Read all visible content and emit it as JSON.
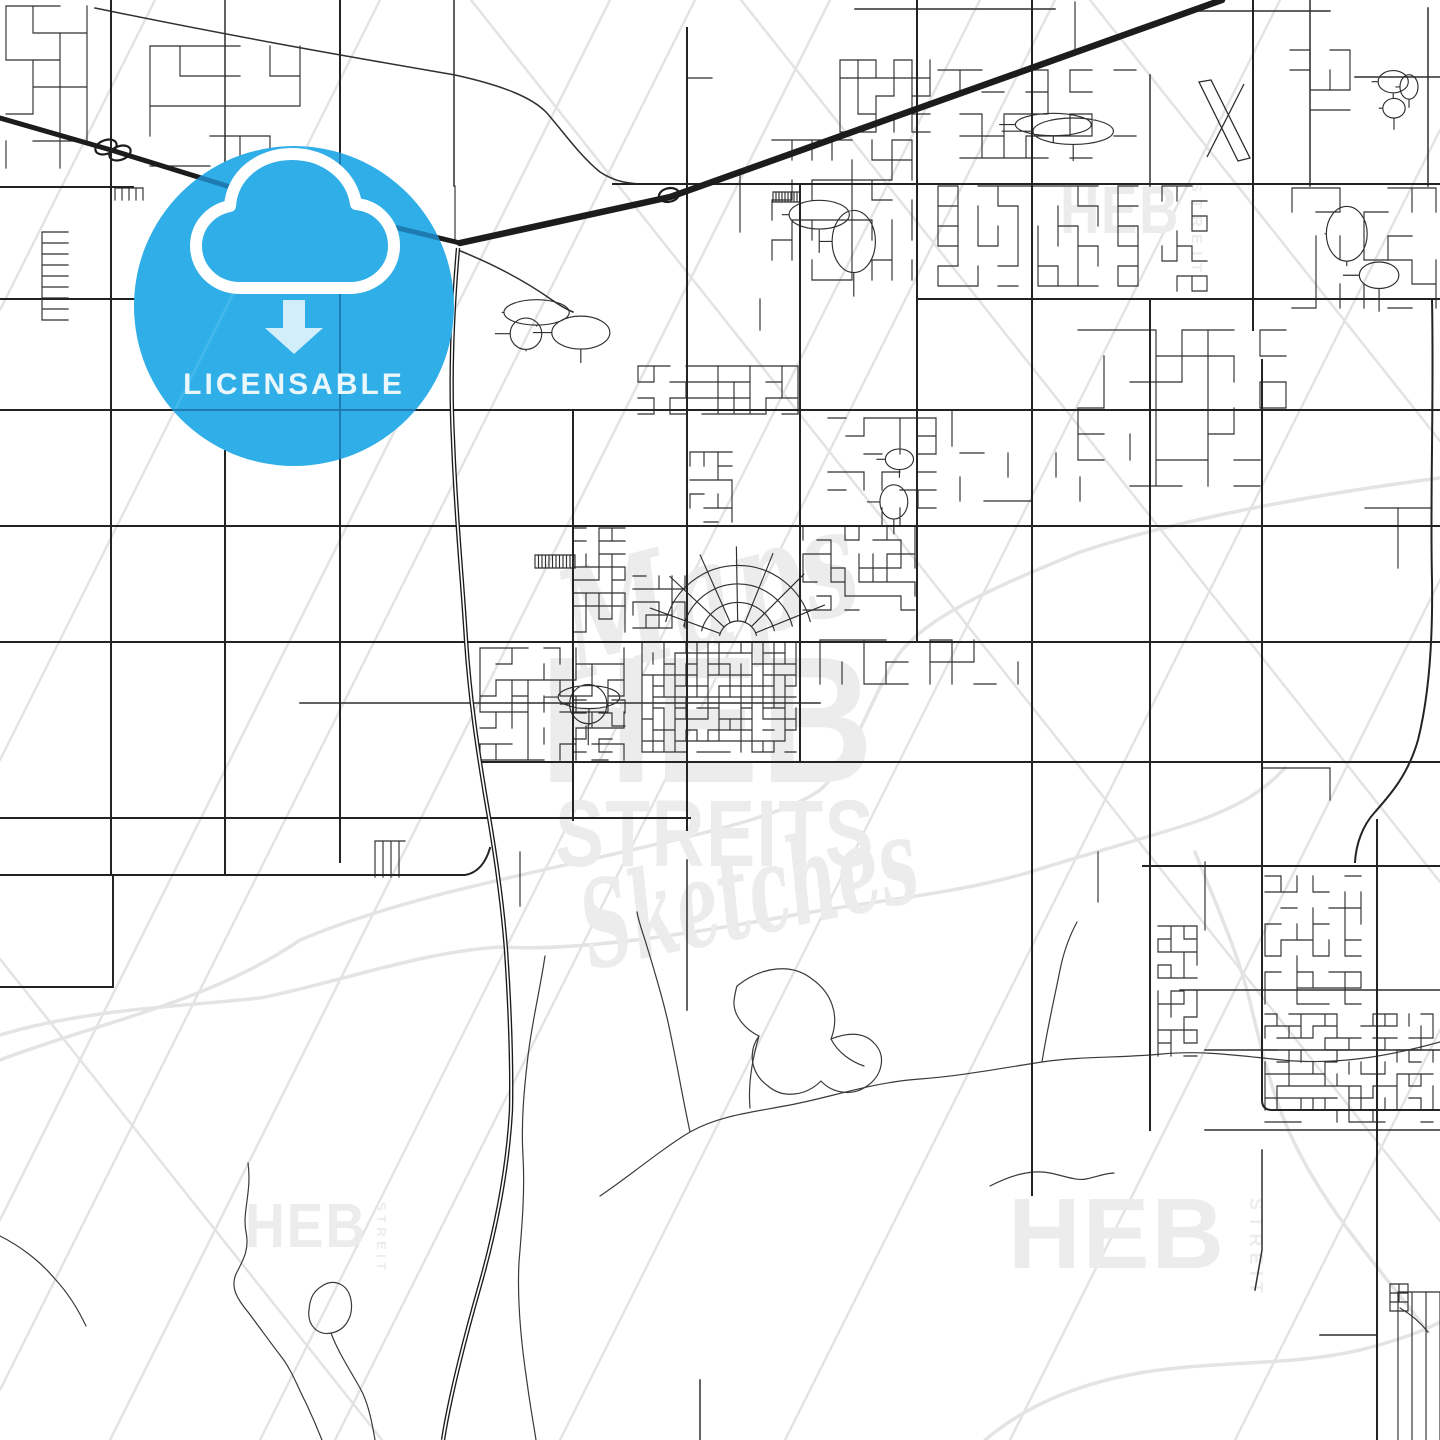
{
  "image": {
    "kind": "licensable-map-sketch-preview",
    "width": 1440,
    "height": 1440
  },
  "badge": {
    "label": "LICENSABLE",
    "icon": "cloud-download-icon",
    "circle_color": "#2FAEE8",
    "label_color": "#E9F7FD",
    "arrow_color": "#D2EEFB",
    "road_tint_through_badge": "#1E7CB2"
  },
  "watermarks": {
    "center": {
      "script_top": "Maps",
      "block_top": "HEB",
      "block_bottom": "STREITS",
      "script_bottom": "Sketches"
    },
    "corner_brand": "HEB",
    "corner_sub": "STREIT",
    "color": "#ECECEC"
  },
  "map_colors": {
    "background": "#FFFFFF",
    "road_minor": "#2F2F2F",
    "road_major": "#232323",
    "highway": "#1C1C1C",
    "creek": "#3A3A3A",
    "utility_line": "#E3E3E3",
    "canal": "#E4E4E4"
  }
}
